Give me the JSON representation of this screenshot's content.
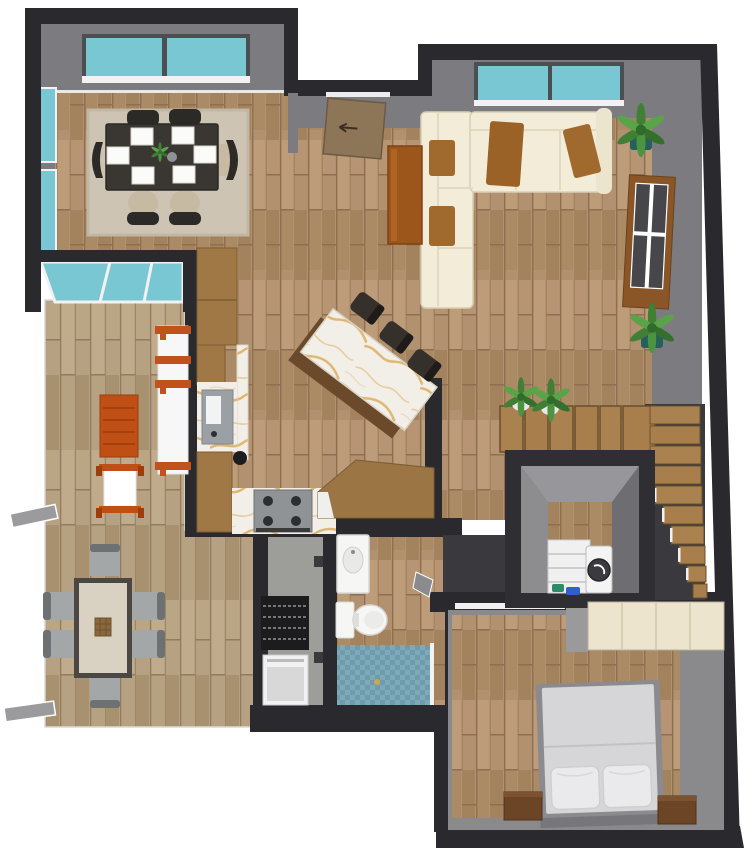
{
  "meta": {
    "description": "3D top-down rendering of a one-storey house floor plan",
    "view": "bird's-eye 3D render, no visible text or UI chrome",
    "background": "#ffffff"
  },
  "palette": {
    "wall_dark": "#2a2a2e",
    "wall_dark2": "#3a3a3e",
    "wall_face": "#7c7c80",
    "wall_face_light": "#97979b",
    "glass_teal": "#79c7d2",
    "frame_white": "#f2f2f2",
    "frame_dark": "#4b4f52",
    "rug": "#cdc4b3",
    "dining_table": "#3a3733",
    "chair_dark": "#2c2a27",
    "seat_beige": "#c6bba2",
    "placemat": "#fbfbf9",
    "sofa_cream": "#f2ecd8",
    "sofa_shade": "#e2dac0",
    "accent_brown": "#a06a2e",
    "throw_brown": "#9a6226",
    "coffee_table": "#9c551b",
    "console_wood": "#8a5527",
    "console_panel": "#47474b",
    "plant_green": "#3f8034",
    "plant_green2": "#5aa348",
    "pot_teal": "#275f5c",
    "pot_white": "#e8e8e8",
    "island_base": "#6b4a2b",
    "marble_base": "#f2efe8",
    "marble_vein": "#d8a44c",
    "stool_dark": "#35302c",
    "counter_wood": "#a07845",
    "sink_gray": "#9aa0a3",
    "stove_gray": "#8f9396",
    "burner_dark": "#2e2e30",
    "orange": "#bf4f14",
    "shelf_white": "#f7f7f7",
    "hall_floor": "#9d9d9a",
    "radiator_dark": "#1c1c1e",
    "appliance_white": "#f2f2f2",
    "porcelain": "#f6f6f4",
    "shower_tile": "#7ba6b6",
    "table2_frame": "#4b4742",
    "table2_top": "#d9d1c2",
    "basket": "#8a683c",
    "chair_gray": "#a3a7a8",
    "chair_gray_back": "#6d7173",
    "stair_tread": "#aa8250",
    "stair_riser": "#6b4e2b",
    "washer_white": "#f4f4f4",
    "washer_drum": "#3b3b3f",
    "detergent_green": "#2e8b6a",
    "detergent_blue": "#2f5fc9",
    "bed_frame": "#8b8b8f",
    "mattress": "#d6d6d8",
    "pillow": "#eaeaec",
    "nightstand": "#6b4526",
    "wardrobe": "#ece4cd",
    "door_wood": "#8d7558",
    "door_flap": "#9b9b9e",
    "wood_floor": "#b29170",
    "wood_floor_pale": "#b6a183"
  },
  "scene": {
    "rooms": [
      {
        "name": "dining-room",
        "position": "top-left",
        "furniture": [
          "dark dining table",
          "6 chairs",
          "6 white placemats",
          "flower centerpiece",
          "beige area rug"
        ],
        "windows": 4
      },
      {
        "name": "living-room",
        "position": "top-right",
        "furniture": [
          "cream L sectional sofa",
          "brown cushions",
          "brown throw",
          "coffee table",
          "media console",
          "potted plants"
        ],
        "windows": 1
      },
      {
        "name": "kitchen",
        "position": "center",
        "furniture": [
          "angled marble island",
          "3 bar stools",
          "pantry cabinet",
          "sink",
          "cooktop",
          "angled wood counter",
          "kettle"
        ]
      },
      {
        "name": "family-room",
        "position": "mid-left",
        "furniture": [
          "orange slatted table",
          "orange chair",
          "white shelf unit with orange shelves"
        ]
      },
      {
        "name": "breakfast-room",
        "position": "bottom-left",
        "furniture": [
          "table with dark frame",
          "6 gray chairs",
          "woven basket"
        ]
      },
      {
        "name": "hallway",
        "position": "bottom-center-left",
        "furniture": [
          "black slatted shelf",
          "white cabinet",
          "2 wall hooks"
        ]
      },
      {
        "name": "bathroom",
        "position": "bottom-center",
        "furniture": [
          "vanity sink",
          "toilet",
          "blue mosaic shower"
        ]
      },
      {
        "name": "staircase",
        "position": "mid-right",
        "furniture": [
          "upper flight 6 treads",
          "lower flight along wall",
          "2 potted plants"
        ]
      },
      {
        "name": "laundry-below-stairs",
        "position": "stairwell opening",
        "furniture": [
          "washing machine",
          "white shelf unit",
          "detergent bottles"
        ]
      },
      {
        "name": "bedroom",
        "position": "bottom-right",
        "furniture": [
          "double bed",
          "2 pillows",
          "2 wood nightstands",
          "cream wardrobe"
        ]
      }
    ],
    "doors": [
      "entry door (top, open)",
      "bathroom door (open)",
      "bedroom doorway",
      "2 exterior door leafs (left)"
    ],
    "counts": {
      "dining_chairs": 6,
      "placemats": 6,
      "bar_stools": 3,
      "breakfast_chairs": 6,
      "potted_plants": 4,
      "pillows": 2,
      "nightstands": 2,
      "upper_treads": 6,
      "lower_treads": 10
    }
  }
}
